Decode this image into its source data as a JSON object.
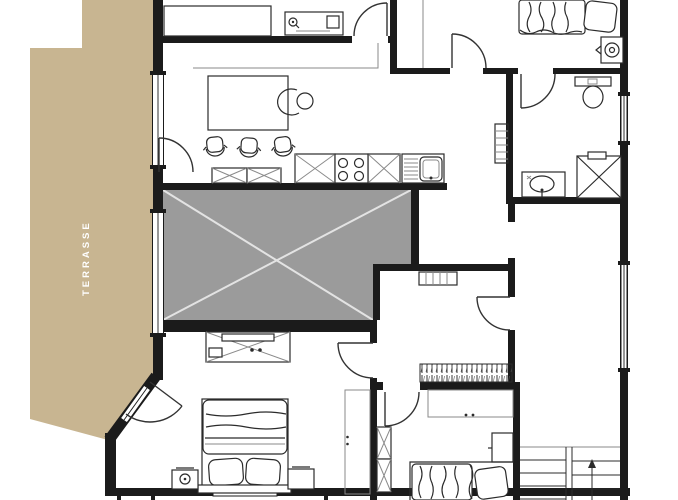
{
  "labels": {
    "terrace": "TERRASSE"
  },
  "colors": {
    "background": "#ffffff",
    "terrace_fill": "#c8b591",
    "terrace_label_text": "#ffffff",
    "wall": "#1b1b1b",
    "shaded_area_fill": "#9b9b9b",
    "shaded_area_cross": "#e3e3e3",
    "furniture_line": "#2b2b2b",
    "thin_line": "#8a8a8a",
    "door_line": "#333333"
  },
  "plan": {
    "type": "floor-plan",
    "features": [
      "terrace",
      "living-dining-area",
      "dining-table",
      "dining-chairs",
      "armchair",
      "desk",
      "wardrobe",
      "kitchen-counter",
      "stove",
      "kitchen-sink",
      "shaded-void-area",
      "hallway",
      "radiator",
      "bathroom",
      "toilet",
      "shower",
      "vanity-sink",
      "washing-machine",
      "double-bed",
      "nightstand",
      "dresser",
      "closet",
      "corridor-wardrobe",
      "duct-shaft",
      "staircase",
      "doors",
      "windows"
    ]
  }
}
